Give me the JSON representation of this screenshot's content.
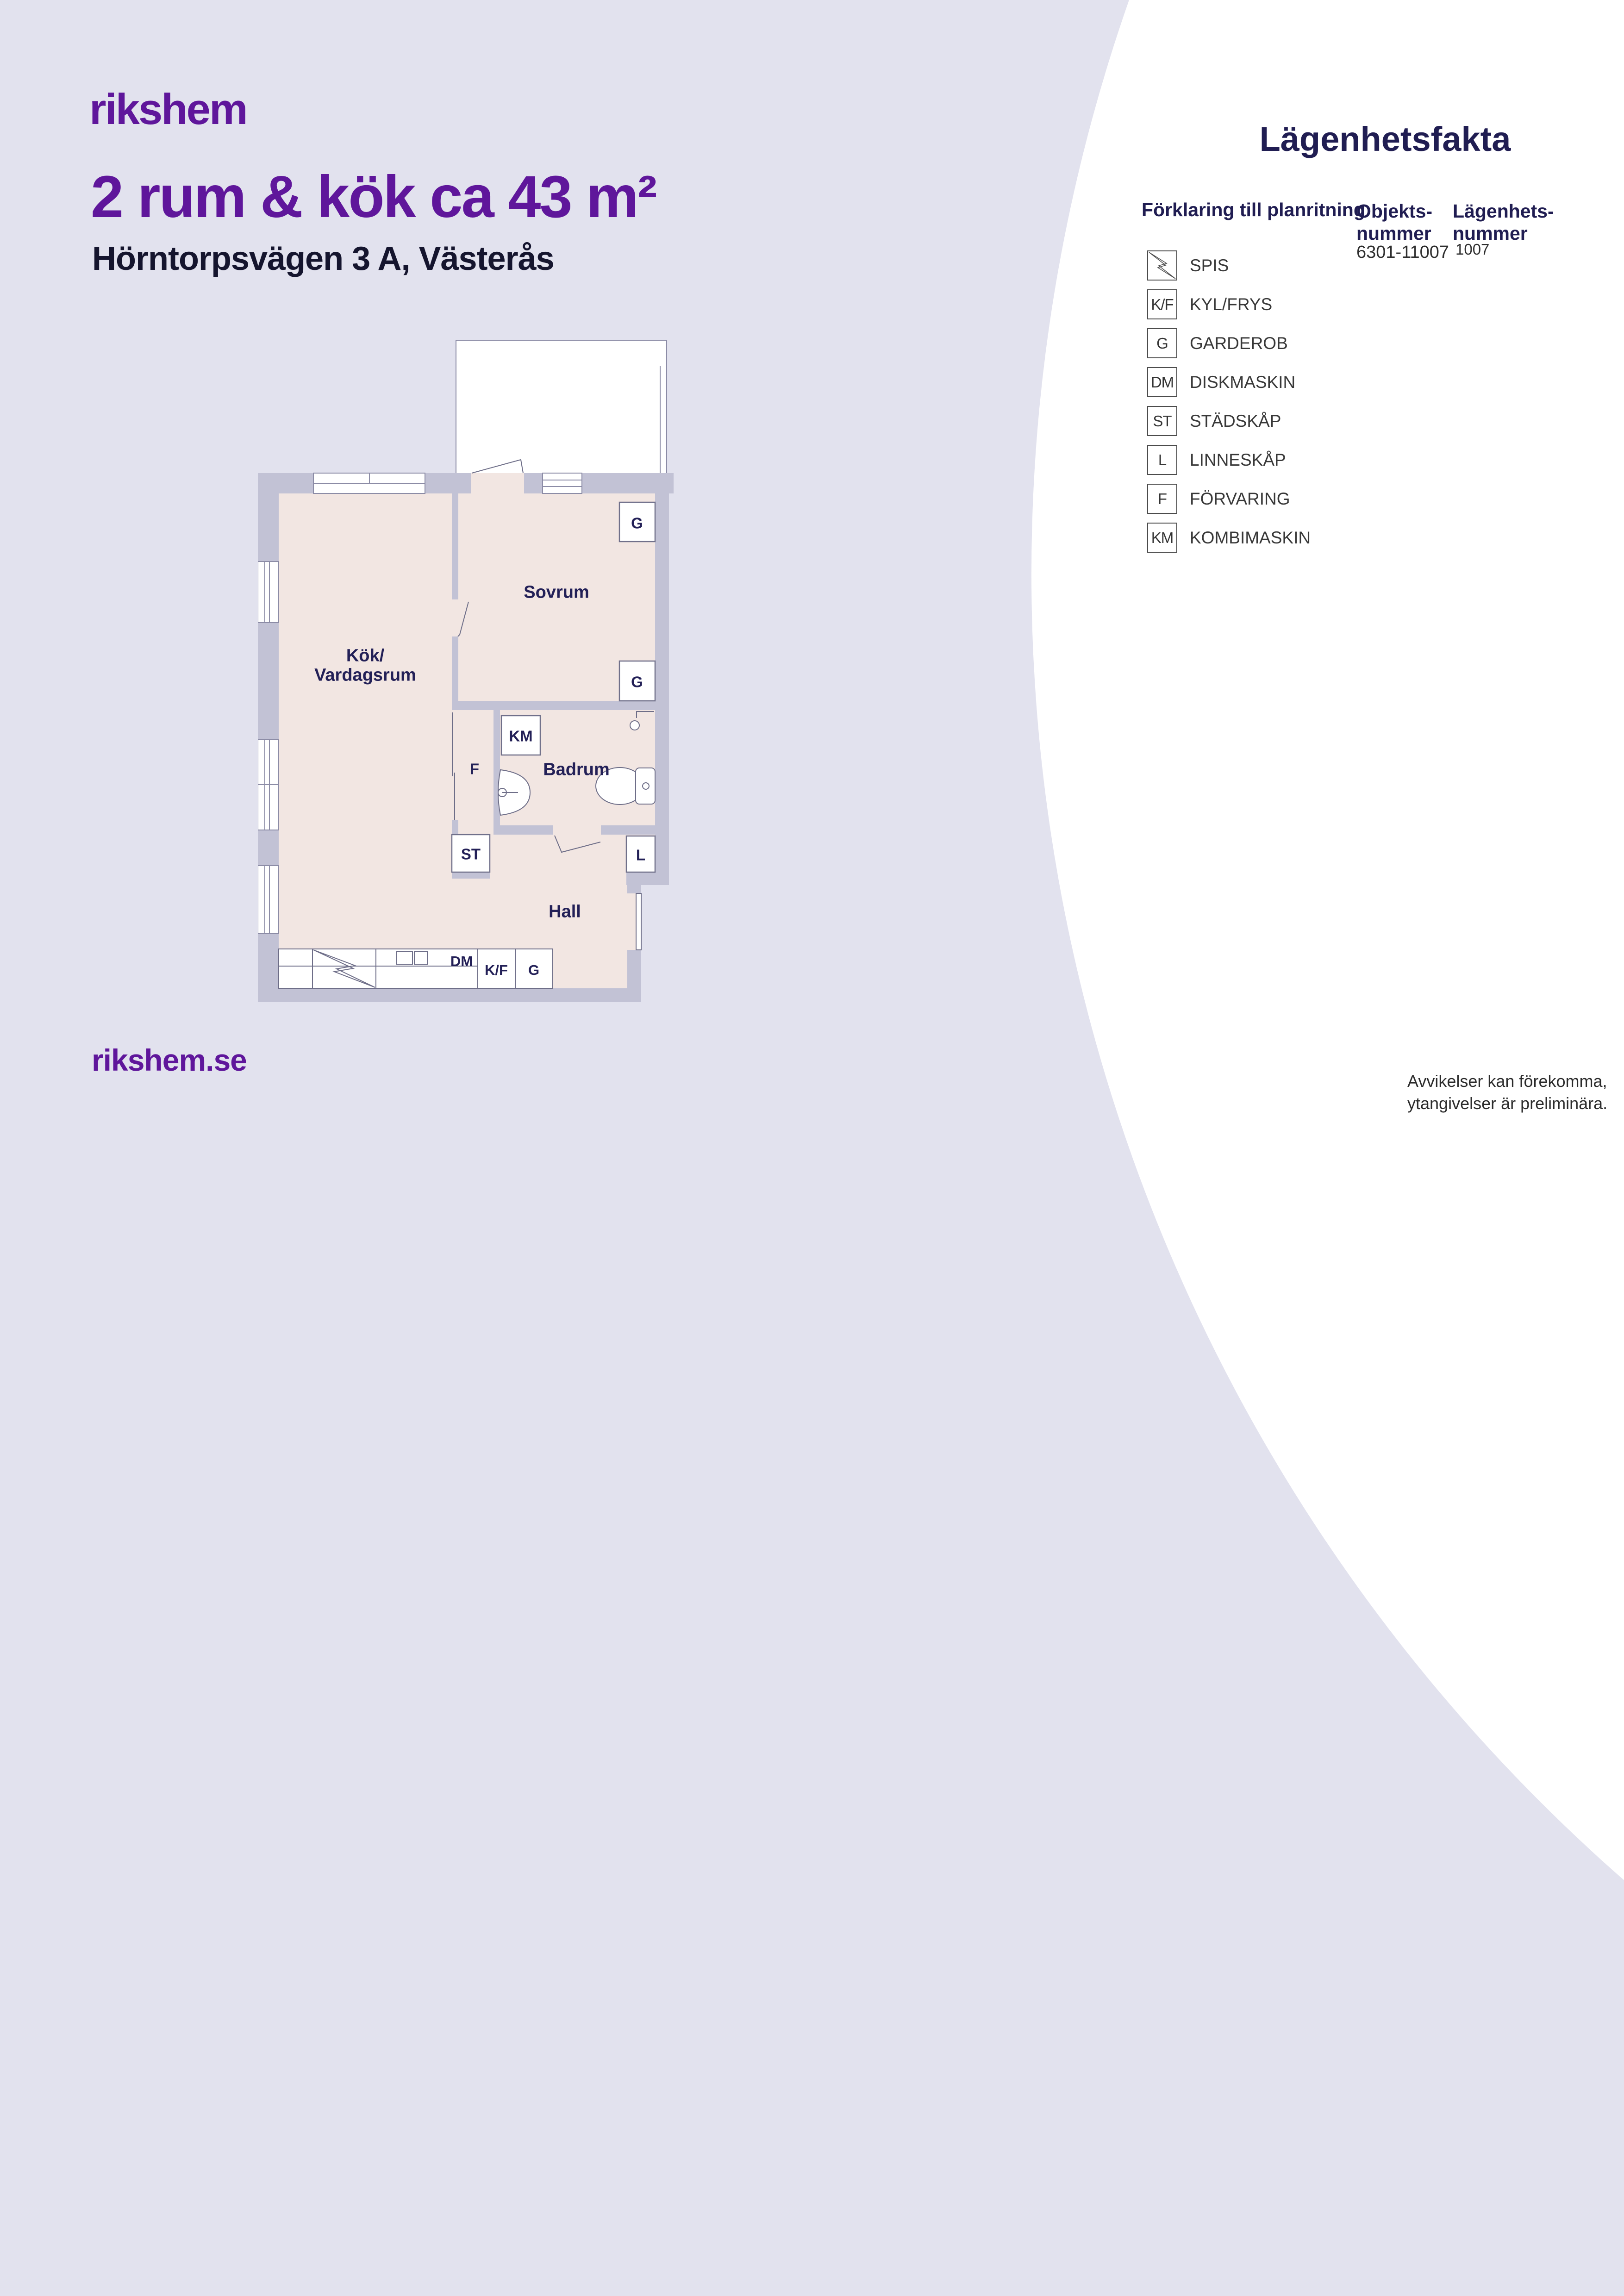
{
  "colors": {
    "background": "#e2e2ee",
    "accent_purple": "#5f169b",
    "heading_navy": "#201d52",
    "plan_label_navy": "#232057",
    "wall_gray": "#c2c2d5",
    "floor_pink": "#f2e6e2",
    "balcony_white": "#ffffff"
  },
  "header": {
    "logo": "rikshem",
    "title": "2 rum & kök ca 43 m²",
    "address": "Hörntorpsvägen 3 A, Västerås"
  },
  "facts_panel": {
    "title": "Lägenhetsfakta",
    "legend_title": "Förklaring till planritning",
    "object_number_label_line1": "Objekts-",
    "object_number_label_line2": "nummer",
    "object_number": "6301-11007",
    "apartment_number_label_line1": "Lägenhets-",
    "apartment_number_label_line2": "nummer",
    "apartment_number": "1007",
    "legend": [
      {
        "symbol": "",
        "icon": "spis-zigzag-icon",
        "label": "SPIS"
      },
      {
        "symbol": "K/F",
        "label": "KYL/FRYS"
      },
      {
        "symbol": "G",
        "label": "GARDEROB"
      },
      {
        "symbol": "DM",
        "label": "DISKMASKIN"
      },
      {
        "symbol": "ST",
        "label": "STÄDSKÅP"
      },
      {
        "symbol": "L",
        "label": "LINNESKÅP"
      },
      {
        "symbol": "F",
        "label": "FÖRVARING"
      },
      {
        "symbol": "KM",
        "label": "KOMBIMASKIN"
      }
    ]
  },
  "floor_plan": {
    "rooms": {
      "kok_line1": "Kök/",
      "kok_line2": "Vardagsrum",
      "sovrum": "Sovrum",
      "badrum": "Badrum",
      "hall": "Hall"
    },
    "codes": {
      "g": "G",
      "km": "KM",
      "f": "F",
      "st": "ST",
      "l": "L",
      "dm": "DM",
      "kf": "K/F"
    }
  },
  "footer": {
    "website": "rikshem.se",
    "disclaimer_line1": "Avvikelser kan förekomma,",
    "disclaimer_line2": "ytangivelser är preliminära."
  }
}
